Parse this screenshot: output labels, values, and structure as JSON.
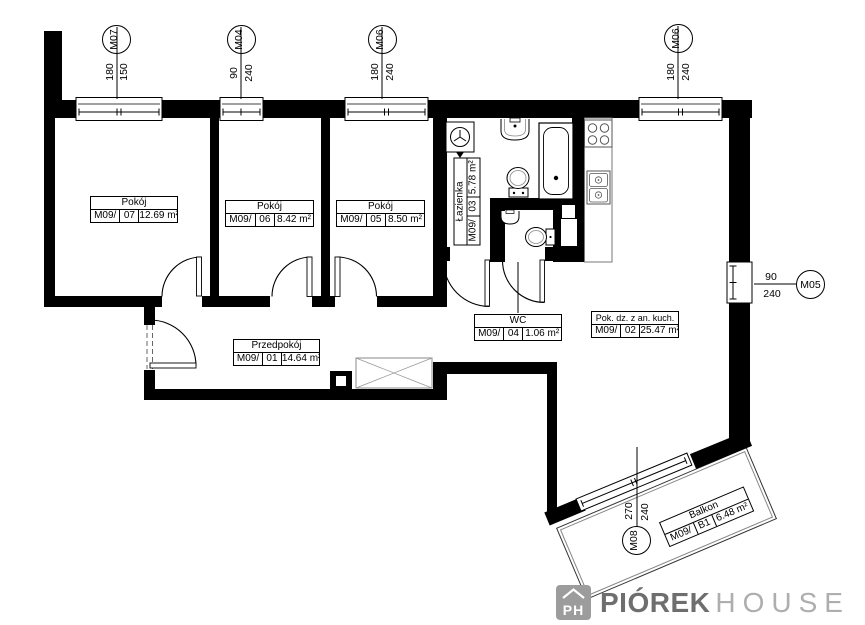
{
  "labels": {
    "pokoj7": {
      "name": "Pokój",
      "unit": "M09/",
      "no": "07",
      "area": "12.69 m²"
    },
    "pokoj6": {
      "name": "Pokój",
      "unit": "M09/",
      "no": "06",
      "area": "8.42 m²"
    },
    "pokoj5": {
      "name": "Pokój",
      "unit": "M09/",
      "no": "05",
      "area": "8.50 m²"
    },
    "przedpokoj": {
      "name": "Przedpokój",
      "unit": "M09/",
      "no": "01",
      "area": "14.64 m²"
    },
    "lazienka": {
      "name": "Łazienka",
      "unit": "M09/",
      "no": "03",
      "area": "5.78 m²"
    },
    "wc": {
      "name": "WC",
      "unit": "M09/",
      "no": "04",
      "area": "1.06 m²"
    },
    "living": {
      "name": "Pok. dz. z an. kuch.",
      "unit": "M09/",
      "no": "02",
      "area": "25.47 m²"
    },
    "balkon": {
      "name": "Balkon",
      "unit": "M09/",
      "no": "B1",
      "area": "6.48 m²"
    }
  },
  "markers": {
    "m07": {
      "id": "M07",
      "dim_a": "180",
      "dim_b": "150"
    },
    "m04": {
      "id": "M04",
      "dim_a": "90",
      "dim_b": "240"
    },
    "m06a": {
      "id": "M06",
      "dim_a": "180",
      "dim_b": "240"
    },
    "m06b": {
      "id": "M06",
      "dim_a": "180",
      "dim_b": "240"
    },
    "m05": {
      "id": "M05",
      "dim_a": "90",
      "dim_b": "240"
    },
    "m08": {
      "id": "M08",
      "dim_a": "270",
      "dim_b": "240"
    }
  },
  "logo": {
    "initials": "PH",
    "brand_bold": "PIÓREK",
    "brand_light": "HOUSE"
  },
  "colors": {
    "wall": "#000000",
    "logo_gray": "#9c9c9c",
    "brand_dark": "#6e6e6e",
    "brand_light": "#aeaeae"
  }
}
